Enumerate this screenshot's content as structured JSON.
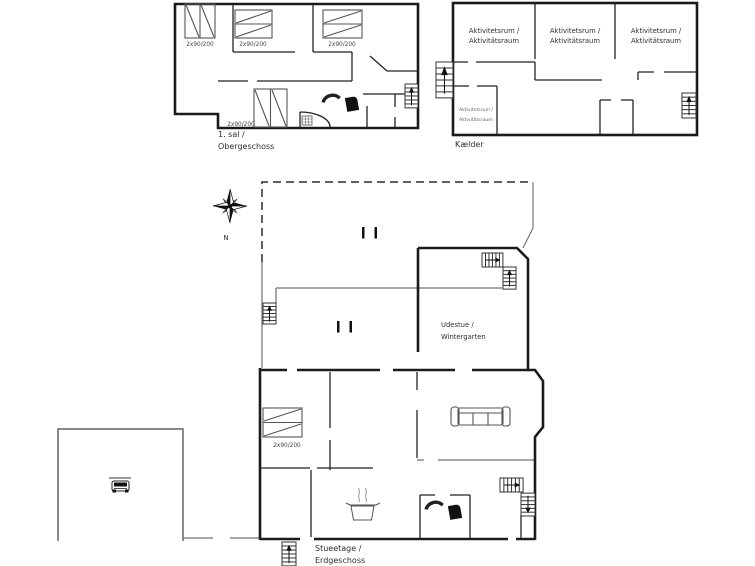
{
  "title": "Holiday house floor plans",
  "compass": {
    "north_label": "N"
  },
  "floors": {
    "upper": {
      "name_line1": "1. sal /",
      "name_line2": "Obergeschoss",
      "bed_labels": [
        "2x90/200",
        "2x90/200",
        "2x90/200",
        "2x90/200"
      ]
    },
    "basement": {
      "name": "Kælder",
      "room_labels": [
        {
          "line1": "Aktivitetsrum /",
          "line2": "Aktivitätsraum"
        },
        {
          "line1": "Aktivitetsrum /",
          "line2": "Aktivitätsraum"
        },
        {
          "line1": "Aktivitetsrum /",
          "line2": "Aktivitätsraum"
        },
        {
          "line1": "Aktivitetsrum /",
          "line2": "Aktivitätsraum"
        }
      ]
    },
    "ground": {
      "name_line1": "Stueetage /",
      "name_line2": "Erdgeschoss",
      "conservatory_line1": "Udestue /",
      "conservatory_line2": "Wintergarten",
      "bed_label": "2x90/200"
    }
  },
  "icons": {
    "compass-rose-icon": "8-point star",
    "stairs-icon": "stepped rectangle with direction arrow",
    "bed-icon": "double mattress with diagonals",
    "sofa-icon": "three-seat sofa top view",
    "armchair-icon": "open arc chair",
    "armchair-filled-icon": "solid chair",
    "car-icon": "car in carport",
    "cooking-pot-icon": "pot with steam",
    "shower-icon": "quarter arc",
    "washbasin-icon": "small grid fixture"
  },
  "colors": {
    "wall": "#1b1b1b",
    "interior_wall": "#222222",
    "terrace_line": "#8a8a8a",
    "furniture": "#555555",
    "background": "#ffffff"
  }
}
